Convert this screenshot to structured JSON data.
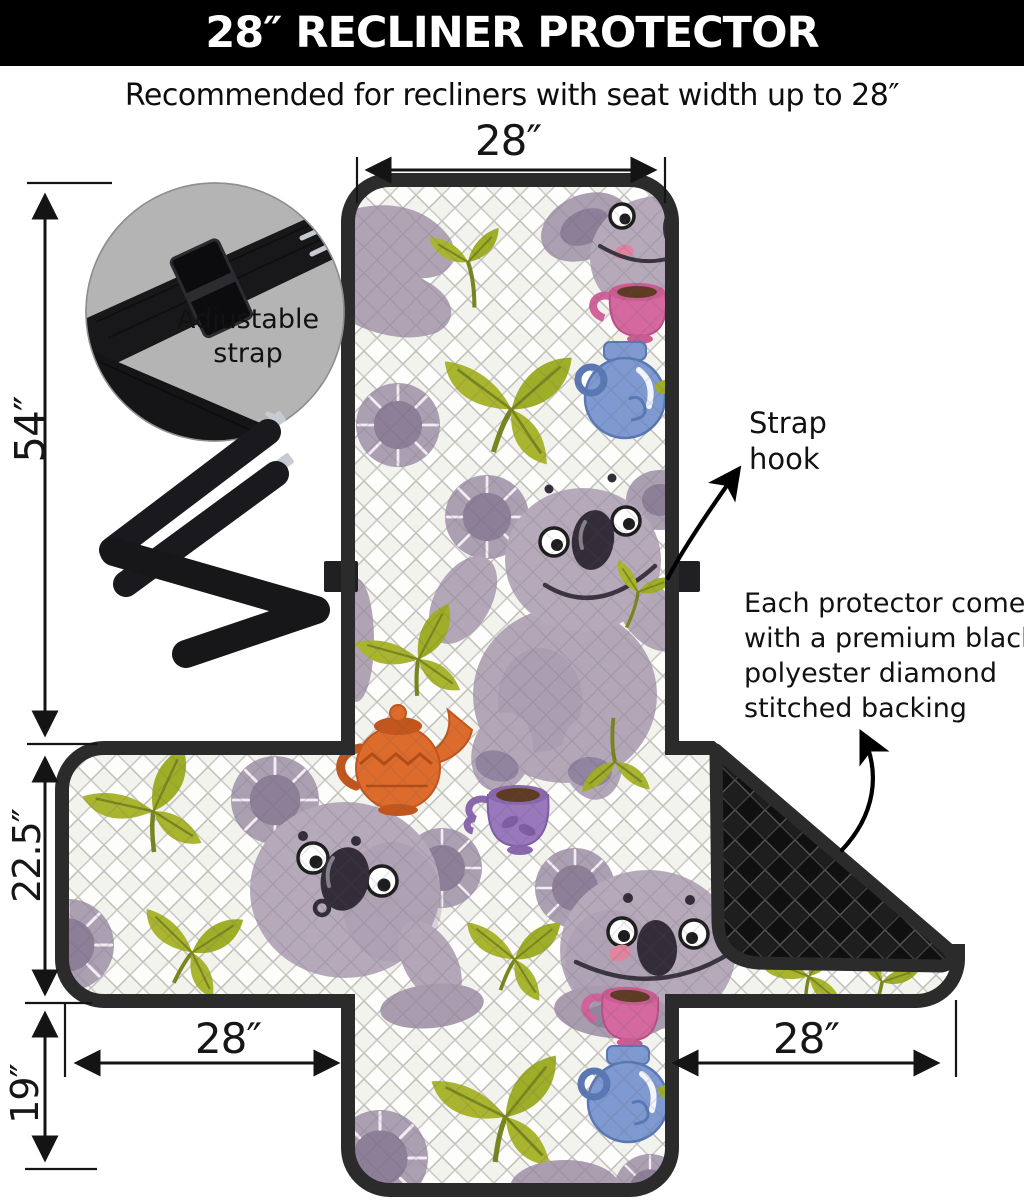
{
  "header": {
    "title": "28″ RECLINER PROTECTOR"
  },
  "subtitle": "Recommended for recliners with seat width up to 28″",
  "dimensions": {
    "backrest_width": "28″",
    "total_height": "54″",
    "seat_section_height": "22.5″",
    "bottom_flap_height": "19″",
    "left_arm_width": "28″",
    "right_arm_width": "28″"
  },
  "callouts": {
    "adjustable_strap": "Adjustable strap",
    "strap_hook": "Strap hook",
    "backing_note": "Each protector comes with a premium black polyester diamond stitched backing"
  },
  "colors": {
    "header_bg": "#000000",
    "header_text": "#ffffff",
    "binding_border": "#2b2b2b",
    "quilt_base": "#f6f6f2",
    "backing_black": "#121212",
    "koala_fur": "#b3a7b8",
    "leaf_green": "#a9b52f",
    "teapot_orange": "#dd6c2c",
    "jug_blue": "#7e9ad0",
    "cup_pink": "#d5699f",
    "cup_purple": "#9a78bd",
    "strap_circle_bg": "#b4b4b4",
    "strap_black": "#18181b"
  },
  "pattern_motifs": [
    "koala",
    "eucalyptus-leaves",
    "teapot",
    "teacup",
    "diamond-quilt"
  ]
}
